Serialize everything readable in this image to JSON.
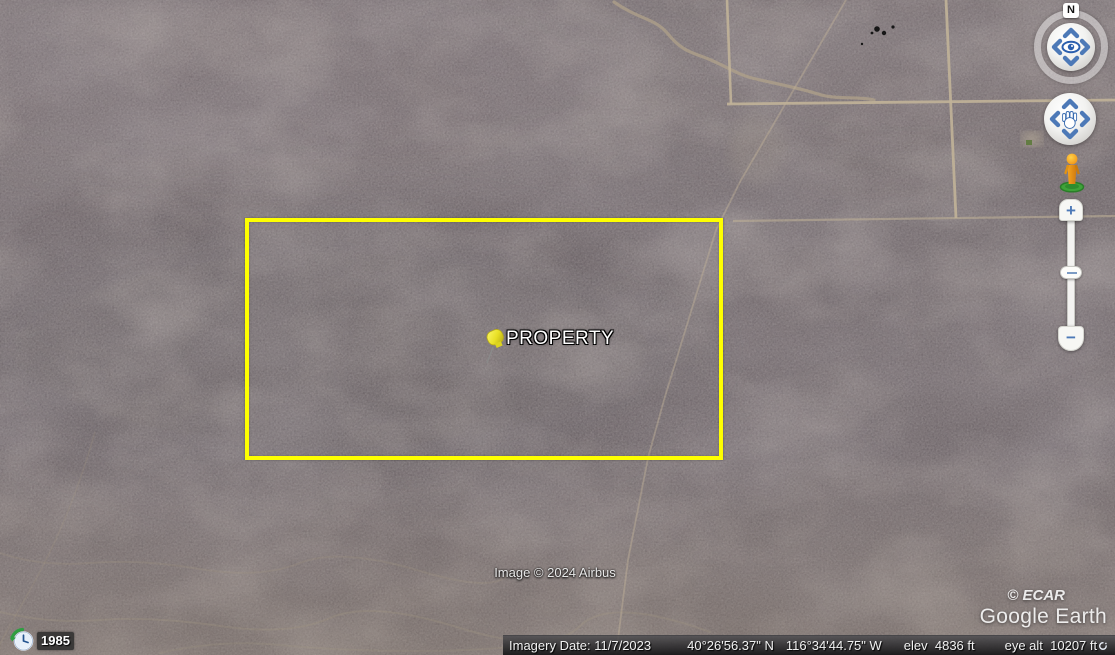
{
  "colors": {
    "boundary_yellow": "#feff00",
    "control_blue": "#4d79b7",
    "pin_yellow": "#ece43a",
    "pegman_orange": "#f09c1f",
    "pegman_base_green": "#3fa339",
    "clock_arrow_green": "#2f9e41",
    "road_tan": "#c1b298"
  },
  "map": {
    "pin_label": "PROPERTY",
    "attribution": "Image © 2024 Airbus",
    "watermark_copyright": "© ECAR",
    "watermark_logo": "Google Earth"
  },
  "historical_imagery": {
    "year": "1985"
  },
  "navigation": {
    "north_label": "N"
  },
  "zoom_controls": {
    "zoom_in_label": "+",
    "zoom_out_label": "−"
  },
  "status_bar": {
    "imagery_date": "Imagery Date: 11/7/2023",
    "latitude": "40°26'56.37\" N",
    "longitude": "116°34'44.75\" W",
    "elevation": "elev  4836 ft",
    "eye_altitude": "eye alt  10207 ft"
  }
}
